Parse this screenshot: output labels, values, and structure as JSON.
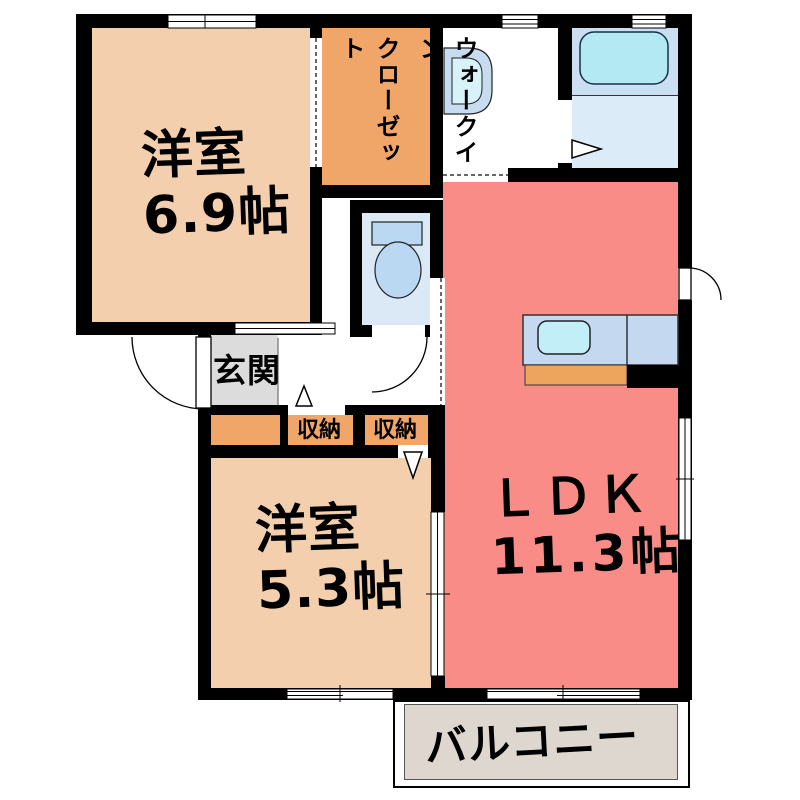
{
  "floorplan": {
    "rooms": {
      "bedroom1": {
        "name": "洋室",
        "size": "6.9帖"
      },
      "bedroom2": {
        "name": "洋室",
        "size": "5.3帖"
      },
      "ldk": {
        "name": "ＬＤＫ",
        "size": "11.3帖"
      },
      "wic": {
        "line1": "ウォークイン",
        "line2": "クローゼット"
      },
      "genkan": {
        "label": "玄関"
      },
      "storage1": {
        "label": "収納"
      },
      "storage2": {
        "label": "収納"
      },
      "balcony": {
        "label": "バルコニー"
      }
    },
    "fixtures": [
      "washbasin-icon",
      "bathtub-icon",
      "toilet-icon",
      "kitchen-sink-icon",
      "kitchen-counter",
      "door-swing-arcs",
      "sliding-windows"
    ],
    "colors": {
      "wall": "#000000",
      "bedroom_fill": "#f4cfae",
      "closet_fill": "#f0a668",
      "ldk_fill": "#f98c86",
      "genkan_fill": "#dcdcdc",
      "balcony_fill": "#ded7cf",
      "water_room_fill": "#dbe9f7",
      "bath_upper_fill": "#ccdff2",
      "bath_lower_fill": "#dcebf8",
      "fixture_blue": "#bad8f1",
      "tub_cyan": "#b3e9f2",
      "counter_blue": "#c4d9f0",
      "sink_cyan": "#c2eff7",
      "counter_orange": "#eda55d"
    }
  }
}
